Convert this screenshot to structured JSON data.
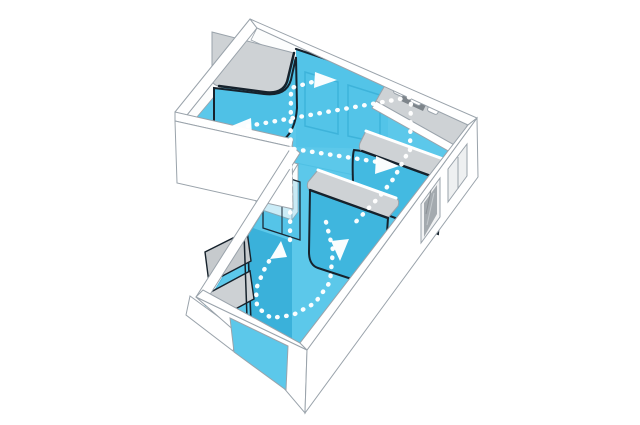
{
  "meta": {
    "title": "Axonometric circulation diagram of an L-shaped apartment",
    "description": "Cutaway axonometric view of an L-shaped studio. Floor and curved storage partitions are highlighted in cyan; gray rounded counter tops sit on the blue volumes; white dotted arrows trace circulation routes between the upper wing, the kitchen side and the lower wing. Windows pierce the east, south and west exterior walls.",
    "background": "#ffffff"
  },
  "palette": {
    "bg": "#ffffff",
    "floor": "#5cc8ea",
    "partition": "#53c4e8",
    "partition_medium": "#43bae1",
    "partition_deep": "#3ab1da",
    "wardrobe_face": "#4fc1e6",
    "volume_b": "#3fb6de",
    "counter_gray": "#ced2d5",
    "furniture_gray": "#c6cacd",
    "glass_gray": "#a4aaaf",
    "wall_white": "#ffffff",
    "wall_line": "#9aa3ab",
    "edge_dark": "#16222c",
    "arrow_white": "#ffffff"
  },
  "circulation": {
    "paths": [
      {
        "id": "path-upper-wing-west",
        "points": [
          [
            410,
            150
          ],
          [
            411,
            97
          ],
          [
            248,
            126
          ]
        ]
      },
      {
        "id": "path-center-east",
        "points": [
          [
            294,
            149
          ],
          [
            378,
            162
          ]
        ]
      },
      {
        "id": "path-spine-north",
        "points": [
          [
            290,
            240
          ],
          [
            291,
            88
          ],
          [
            316,
            81
          ]
        ]
      },
      {
        "id": "path-gap-south",
        "points": [
          [
            406,
            156
          ],
          [
            394,
            178
          ],
          [
            380,
            196
          ],
          [
            365,
            212
          ],
          [
            352,
            226
          ]
        ]
      },
      {
        "id": "path-lower-loop",
        "points": [
          [
            326,
            222
          ],
          [
            333,
            250
          ],
          [
            330,
            282
          ],
          [
            315,
            303
          ],
          [
            293,
            315
          ],
          [
            271,
            318
          ],
          [
            257,
            307
          ],
          [
            256,
            289
          ],
          [
            264,
            270
          ],
          [
            272,
            256
          ]
        ]
      }
    ],
    "arrows": [
      {
        "id": "arrow-east-upper",
        "direction": "east",
        "tip": [
          337,
          80
        ],
        "base": [
          [
            315,
            72
          ],
          [
            314,
            88
          ]
        ]
      },
      {
        "id": "arrow-west-upper",
        "direction": "west",
        "tip": [
          229,
          127
        ],
        "base": [
          [
            251,
            118
          ],
          [
            252,
            136
          ]
        ]
      },
      {
        "id": "arrow-east-middle",
        "direction": "east",
        "tip": [
          399,
          166
        ],
        "base": [
          [
            376,
            156
          ],
          [
            375,
            174
          ]
        ]
      },
      {
        "id": "arrow-south-center",
        "direction": "south",
        "tip": [
          340,
          261
        ],
        "base": [
          [
            331,
            241
          ],
          [
            349,
            239
          ]
        ]
      },
      {
        "id": "arrow-north-lower",
        "direction": "north",
        "tip": [
          281,
          241
        ],
        "base": [
          [
            270,
            259
          ],
          [
            287,
            257
          ]
        ]
      }
    ]
  }
}
